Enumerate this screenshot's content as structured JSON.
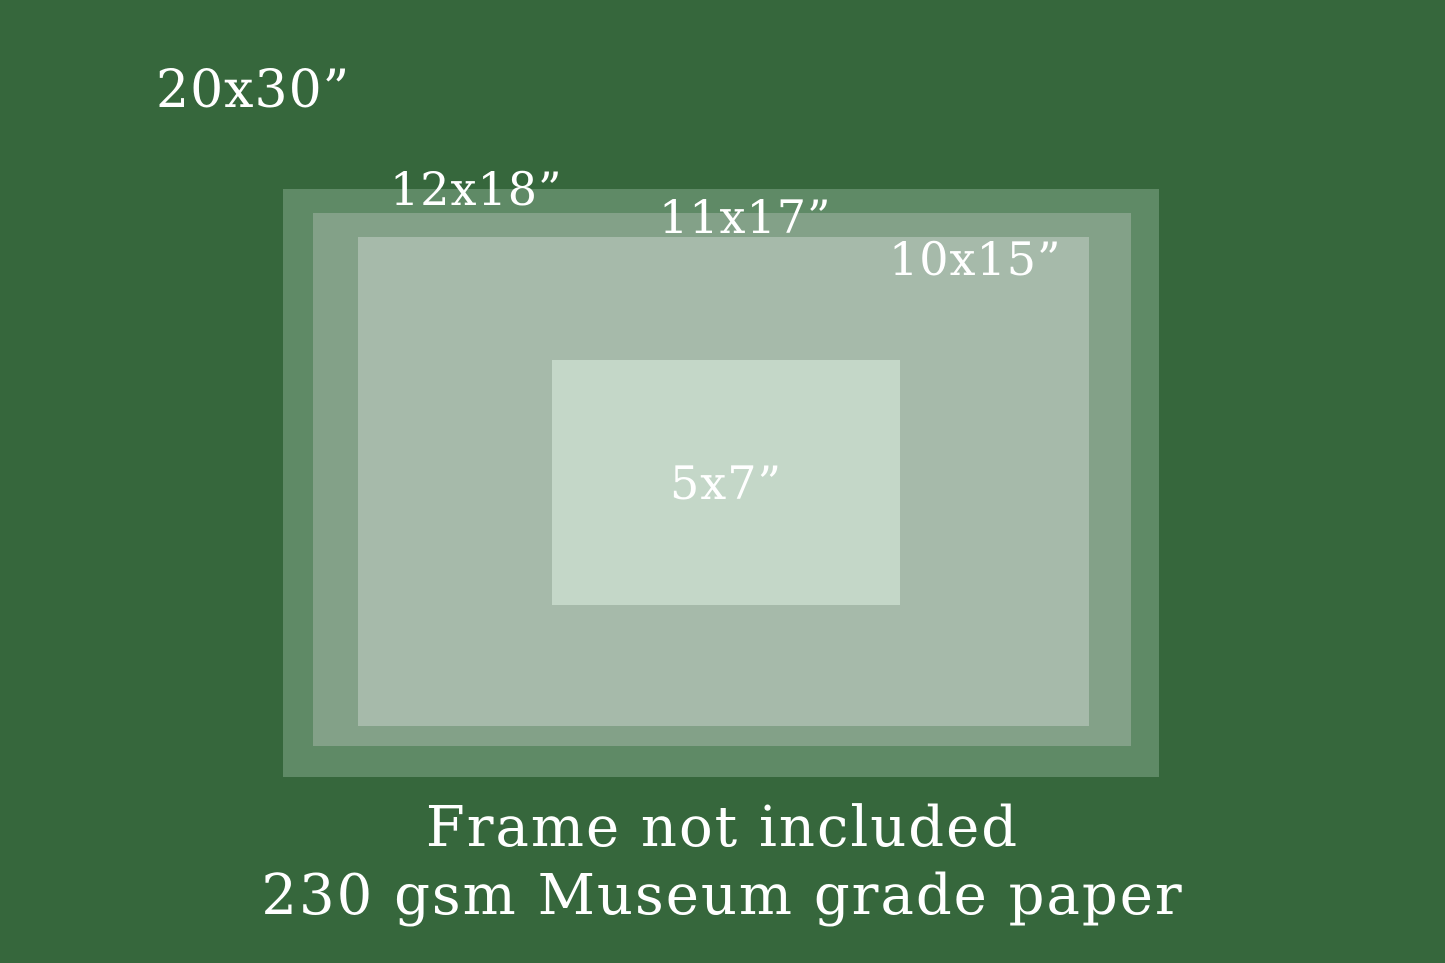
{
  "colors": {
    "background": "#36673C",
    "rect_12x18": "#5F8A66",
    "rect_11x17": "#83A188",
    "rect_10x15": "#A6BAAA",
    "rect_5x7": "#C4D7C8",
    "text": "#FFFFFF"
  },
  "size_labels": {
    "s20x30": "20x30”",
    "s12x18": "12x18”",
    "s11x17": "11x17”",
    "s10x15": "10x15”",
    "s5x7": "5x7”"
  },
  "footer": {
    "line1": "Frame not included",
    "line2": "230 gsm Museum grade paper"
  }
}
